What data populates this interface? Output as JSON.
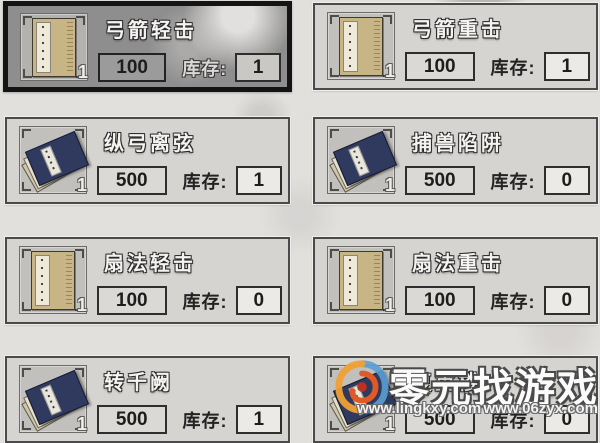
{
  "labels": {
    "stock": "库存:"
  },
  "cards": [
    {
      "title": "弓箭轻击",
      "price": "100",
      "stock": "1",
      "icon": "book",
      "badge": "1",
      "selected": true
    },
    {
      "title": "弓箭重击",
      "price": "100",
      "stock": "1",
      "icon": "book",
      "badge": "1",
      "selected": false
    },
    {
      "title": "纵弓离弦",
      "price": "500",
      "stock": "1",
      "icon": "stack",
      "badge": "1",
      "selected": false
    },
    {
      "title": "捕兽陷阱",
      "price": "500",
      "stock": "0",
      "icon": "stack",
      "badge": "1",
      "selected": false
    },
    {
      "title": "扇法轻击",
      "price": "100",
      "stock": "0",
      "icon": "book",
      "badge": "1",
      "selected": false
    },
    {
      "title": "扇法重击",
      "price": "100",
      "stock": "0",
      "icon": "book",
      "badge": "1",
      "selected": false
    },
    {
      "title": "转千阙",
      "price": "500",
      "stock": "1",
      "icon": "stack",
      "badge": "1",
      "selected": false
    },
    {
      "title": "复重楼",
      "price": "500",
      "stock": "0",
      "icon": "stack",
      "badge": "1",
      "selected": false
    }
  ],
  "watermark": {
    "brand": "零元找游戏",
    "url_left": "www.lingkxy.com",
    "url_right": "www.06zyx.com"
  },
  "colors": {
    "background": "#e2e0dd",
    "card_fill": "#d6d4d1",
    "card_selected_fill": "#8e8e8e",
    "card_selected_border": "#141414",
    "book_cover": "#c7b586",
    "stack_book_navy": "#2f3a5e",
    "text_dark": "#1d1d1d",
    "title_light": "#f4f3f1"
  }
}
